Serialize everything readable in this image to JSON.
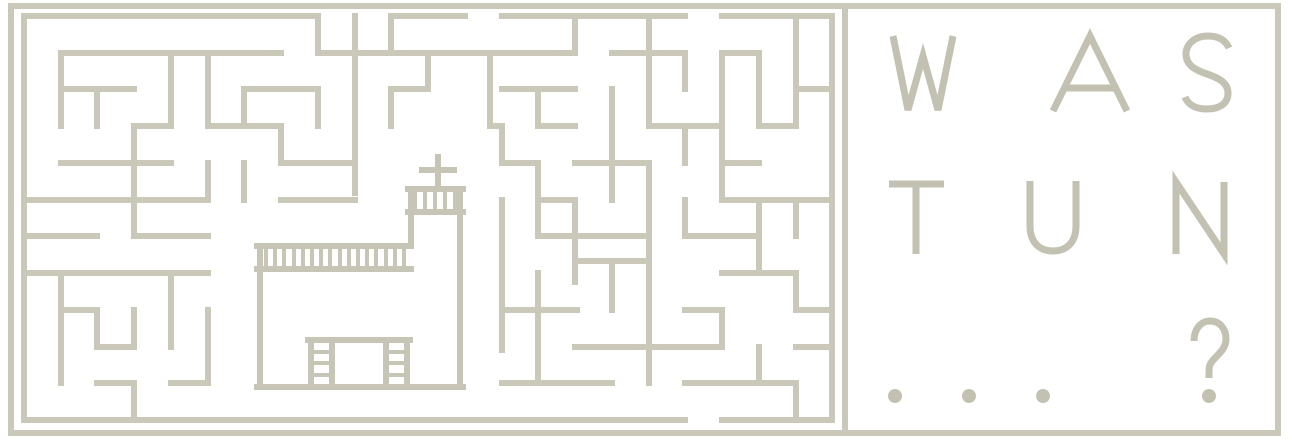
{
  "canvas": {
    "width": 1292,
    "height": 443,
    "background": "#ffffff"
  },
  "colors": {
    "frame_line": "#c9c8b9",
    "maze_line": "#c9c8b9",
    "church_line": "#c6c5b6",
    "headline_text": "#c3c2b2"
  },
  "frame": {
    "outer": {
      "x": 11,
      "y": 6,
      "width": 1267,
      "height": 427,
      "stroke_width": 6
    },
    "divider": {
      "x": 845,
      "y1": 6,
      "y2": 433,
      "stroke_width": 6
    }
  },
  "maze": {
    "stroke_width": 6,
    "segments": [
      [
        24,
        16,
        318,
        16
      ],
      [
        391,
        16,
        465,
        16
      ],
      [
        502,
        16,
        685,
        16
      ],
      [
        722,
        16,
        832,
        16
      ],
      [
        24,
        16,
        24,
        420
      ],
      [
        832,
        16,
        832,
        420
      ],
      [
        24,
        420,
        685,
        420
      ],
      [
        722,
        420,
        832,
        420
      ],
      [
        61,
        53,
        281,
        53
      ],
      [
        61,
        53,
        61,
        126
      ],
      [
        171,
        53,
        171,
        126
      ],
      [
        208,
        53,
        208,
        126
      ],
      [
        61,
        89,
        134,
        89
      ],
      [
        97,
        89,
        97,
        126
      ],
      [
        134,
        126,
        171,
        126
      ],
      [
        134,
        126,
        134,
        236
      ],
      [
        61,
        163,
        171,
        163
      ],
      [
        24,
        200,
        208,
        200
      ],
      [
        208,
        163,
        208,
        200
      ],
      [
        244,
        89,
        318,
        89
      ],
      [
        244,
        89,
        244,
        126
      ],
      [
        208,
        126,
        281,
        126
      ],
      [
        281,
        126,
        281,
        163
      ],
      [
        281,
        163,
        355,
        163
      ],
      [
        244,
        163,
        244,
        200
      ],
      [
        318,
        89,
        318,
        126
      ],
      [
        318,
        16,
        318,
        53
      ],
      [
        318,
        53,
        575,
        53
      ],
      [
        355,
        16,
        355,
        193
      ],
      [
        391,
        16,
        391,
        53
      ],
      [
        428,
        53,
        428,
        89
      ],
      [
        391,
        89,
        428,
        89
      ],
      [
        391,
        89,
        391,
        126
      ],
      [
        490,
        53,
        490,
        126
      ],
      [
        490,
        126,
        502,
        126
      ],
      [
        502,
        126,
        502,
        163
      ],
      [
        502,
        163,
        538,
        163
      ],
      [
        538,
        163,
        538,
        236
      ],
      [
        538,
        200,
        575,
        200
      ],
      [
        502,
        89,
        575,
        89
      ],
      [
        538,
        89,
        538,
        126
      ],
      [
        538,
        126,
        575,
        126
      ],
      [
        281,
        200,
        355,
        200
      ],
      [
        502,
        200,
        502,
        350
      ],
      [
        575,
        16,
        575,
        53
      ],
      [
        612,
        53,
        685,
        53
      ],
      [
        649,
        16,
        649,
        126
      ],
      [
        685,
        53,
        685,
        89
      ],
      [
        722,
        53,
        759,
        53
      ],
      [
        722,
        53,
        722,
        200
      ],
      [
        759,
        53,
        759,
        126
      ],
      [
        759,
        126,
        796,
        126
      ],
      [
        796,
        16,
        796,
        126
      ],
      [
        796,
        89,
        832,
        89
      ],
      [
        612,
        89,
        612,
        200
      ],
      [
        649,
        126,
        722,
        126
      ],
      [
        685,
        126,
        685,
        163
      ],
      [
        575,
        163,
        649,
        163
      ],
      [
        722,
        163,
        759,
        163
      ],
      [
        722,
        200,
        832,
        200
      ],
      [
        575,
        200,
        575,
        282
      ],
      [
        649,
        163,
        649,
        383
      ],
      [
        685,
        200,
        685,
        236
      ],
      [
        759,
        200,
        759,
        273
      ],
      [
        796,
        200,
        796,
        236
      ],
      [
        24,
        236,
        97,
        236
      ],
      [
        134,
        236,
        208,
        236
      ],
      [
        24,
        273,
        208,
        273
      ],
      [
        61,
        273,
        61,
        383
      ],
      [
        61,
        310,
        97,
        310
      ],
      [
        97,
        310,
        97,
        347
      ],
      [
        97,
        347,
        134,
        347
      ],
      [
        134,
        310,
        134,
        347
      ],
      [
        171,
        273,
        171,
        347
      ],
      [
        208,
        310,
        208,
        383
      ],
      [
        97,
        383,
        134,
        383
      ],
      [
        134,
        383,
        134,
        420
      ],
      [
        171,
        383,
        208,
        383
      ],
      [
        538,
        236,
        649,
        236
      ],
      [
        685,
        236,
        759,
        236
      ],
      [
        722,
        273,
        796,
        273
      ],
      [
        796,
        273,
        796,
        310
      ],
      [
        502,
        310,
        577,
        310
      ],
      [
        538,
        273,
        538,
        383
      ],
      [
        502,
        383,
        612,
        383
      ],
      [
        575,
        261,
        649,
        261
      ],
      [
        612,
        261,
        612,
        310
      ],
      [
        575,
        347,
        722,
        347
      ],
      [
        722,
        310,
        722,
        347
      ],
      [
        685,
        310,
        722,
        310
      ],
      [
        759,
        347,
        759,
        383
      ],
      [
        685,
        383,
        796,
        383
      ],
      [
        796,
        383,
        796,
        420
      ],
      [
        796,
        347,
        832,
        347
      ],
      [
        796,
        310,
        832,
        310
      ]
    ]
  },
  "church": {
    "stroke_width": 6,
    "stripe_width": 4,
    "walls": [
      [
        438,
        157,
        438,
        189
      ],
      [
        422,
        170,
        454,
        170
      ],
      [
        408,
        189,
        463,
        189
      ],
      [
        408,
        212,
        463,
        212
      ],
      [
        411,
        189,
        411,
        246
      ],
      [
        460,
        189,
        460,
        387
      ],
      [
        257,
        246,
        411,
        246
      ],
      [
        257,
        269,
        411,
        269
      ],
      [
        260,
        246,
        260,
        387
      ],
      [
        257,
        387,
        463,
        387
      ],
      [
        308,
        340,
        410,
        340
      ],
      [
        311,
        340,
        311,
        387
      ],
      [
        332,
        340,
        332,
        387
      ],
      [
        386,
        340,
        386,
        387
      ],
      [
        407,
        340,
        407,
        387
      ]
    ],
    "stripes": [
      [
        415,
        191,
        415,
        212
      ],
      [
        425,
        191,
        425,
        212
      ],
      [
        435,
        191,
        435,
        212
      ],
      [
        445,
        191,
        445,
        212
      ],
      [
        455,
        191,
        455,
        212
      ],
      [
        266,
        248,
        266,
        269
      ],
      [
        275,
        248,
        275,
        269
      ],
      [
        284,
        248,
        284,
        269
      ],
      [
        294,
        248,
        294,
        269
      ],
      [
        303,
        248,
        303,
        269
      ],
      [
        312,
        248,
        312,
        269
      ],
      [
        321,
        248,
        321,
        269
      ],
      [
        330,
        248,
        330,
        269
      ],
      [
        340,
        248,
        340,
        269
      ],
      [
        349,
        248,
        349,
        269
      ],
      [
        358,
        248,
        358,
        269
      ],
      [
        367,
        248,
        367,
        269
      ],
      [
        376,
        248,
        376,
        269
      ],
      [
        386,
        248,
        386,
        269
      ],
      [
        395,
        248,
        395,
        269
      ],
      [
        404,
        248,
        404,
        269
      ],
      [
        313,
        352,
        330,
        352
      ],
      [
        313,
        363,
        330,
        363
      ],
      [
        313,
        375,
        330,
        375
      ],
      [
        388,
        352,
        405,
        352
      ],
      [
        388,
        363,
        405,
        363
      ],
      [
        388,
        375,
        405,
        375
      ]
    ]
  },
  "headline": {
    "lines": [
      {
        "text": "WAS"
      },
      {
        "text": "TUN"
      },
      {
        "text": "...?"
      }
    ],
    "stroke_width": 7,
    "rows": [
      {
        "y": 35,
        "glyphs": [
          {
            "char": "W",
            "x": 892
          },
          {
            "char": "A",
            "x": 1050
          },
          {
            "char": "S",
            "x": 1182
          }
        ]
      },
      {
        "y": 181,
        "glyphs": [
          {
            "char": "T",
            "x": 888
          },
          {
            "char": "U",
            "x": 1027
          },
          {
            "char": "N",
            "x": 1173
          }
        ]
      },
      {
        "y": 320,
        "glyphs": [
          {
            "char": ".",
            "x": 888
          },
          {
            "char": ".",
            "x": 962
          },
          {
            "char": ".",
            "x": 1036
          },
          {
            "char": "?",
            "x": 1192
          }
        ]
      }
    ]
  }
}
